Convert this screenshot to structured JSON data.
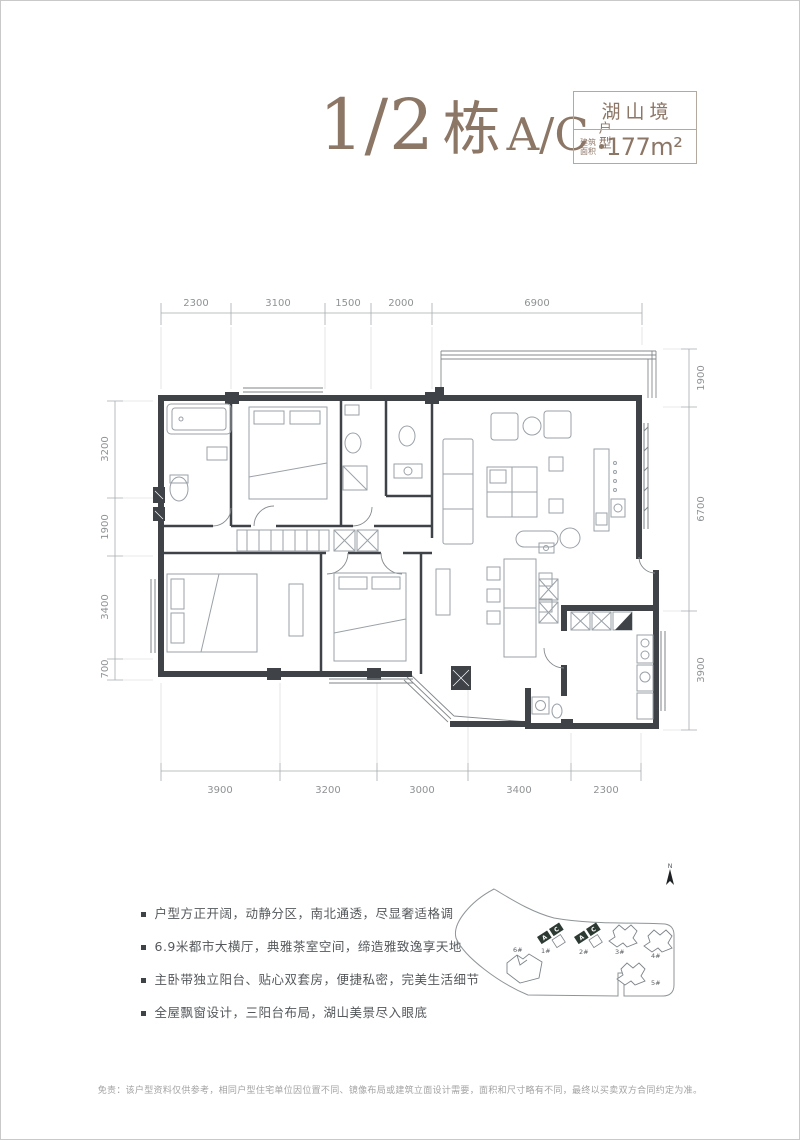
{
  "header": {
    "block": "1/2",
    "block_word": "栋",
    "unit": "A/C",
    "type_label": "户型",
    "project": "湖山境",
    "area_prefix_l1": "建筑",
    "area_prefix_l2": "面积",
    "area_value": "177m²"
  },
  "colors": {
    "title": "#8c7666",
    "wall": "#3f4348",
    "furniture": "#9aa1a7",
    "dimension": "#8f9294",
    "highlight_unit": "#2c3a33"
  },
  "dims": {
    "top": [
      "2300",
      "3100",
      "1500",
      "2000",
      "6900"
    ],
    "bottom": [
      "3900",
      "3200",
      "3000",
      "3400",
      "2300"
    ],
    "left": [
      "3200",
      "1900",
      "3400",
      "700"
    ],
    "right": [
      "1900",
      "6700",
      "3900"
    ]
  },
  "features": {
    "items": [
      "户型方正开阔，动静分区，南北通透，尽显奢适格调",
      "6.9米都市大横厅，典雅茶室空间，缔造雅致逸享天地",
      "主卧带独立阳台、贴心双套房，便捷私密，完美生活细节",
      "全屋飘窗设计，三阳台布局，湖山美景尽入眼底"
    ]
  },
  "site": {
    "north": "N",
    "buildings": [
      "1#",
      "2#",
      "3#",
      "4#",
      "5#",
      "6#"
    ],
    "unit_a": "A",
    "unit_c": "C"
  },
  "footer": {
    "disclaimer": "免责：该户型资料仅供参考，相同户型住宅单位因位置不同、镜像布局或建筑立面设计需要，面积和尺寸略有不同，最终以买卖双方合同约定为准。"
  }
}
